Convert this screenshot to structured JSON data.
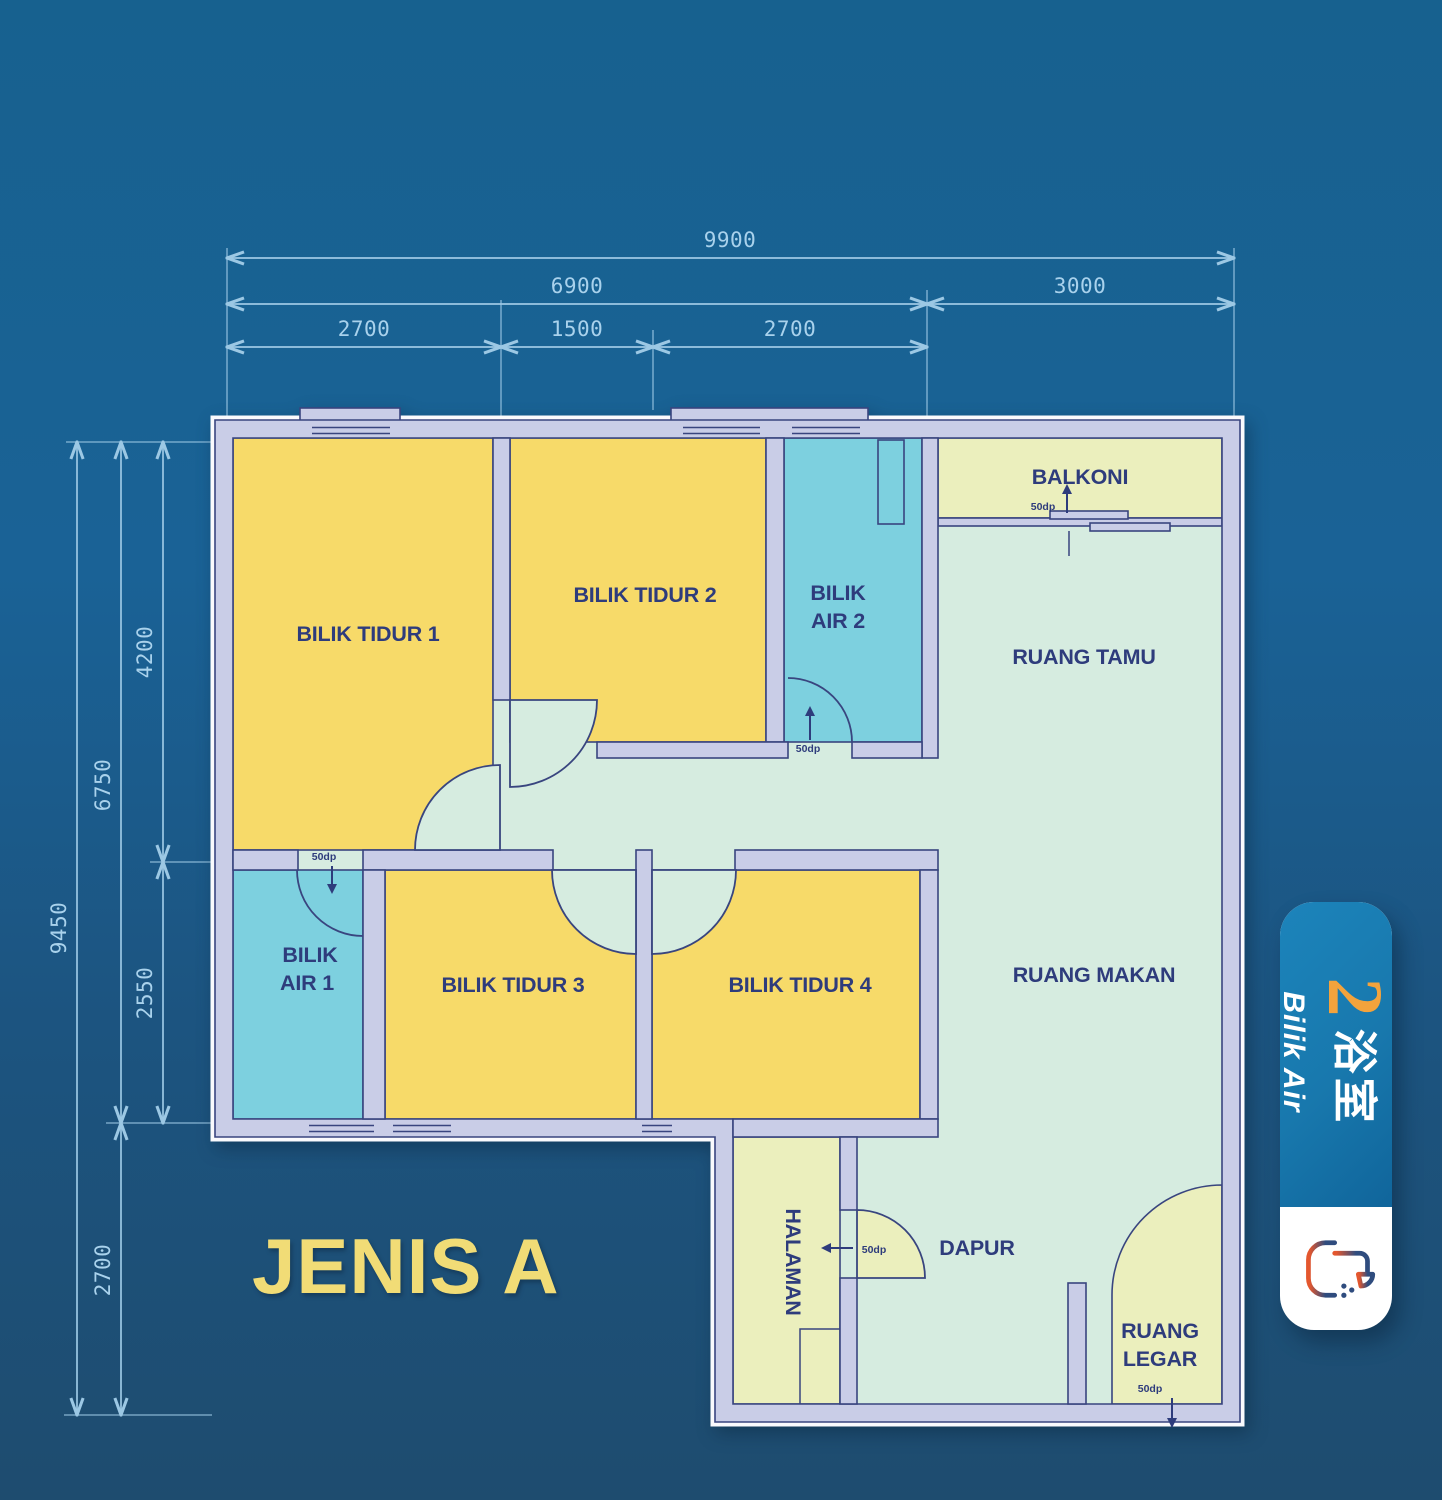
{
  "page": {
    "title": "JENIS A"
  },
  "floor_plan": {
    "rooms": {
      "bilik_tidur_1": "BILIK TIDUR 1",
      "bilik_tidur_2": "BILIK TIDUR 2",
      "bilik_tidur_3": "BILIK TIDUR 3",
      "bilik_tidur_4": "BILIK TIDUR 4",
      "bilik_air_1_line1": "BILIK",
      "bilik_air_1_line2": "AIR 1",
      "bilik_air_2_line1": "BILIK",
      "bilik_air_2_line2": "AIR 2",
      "ruang_tamu": "RUANG TAMU",
      "ruang_makan": "RUANG MAKAN",
      "balkoni": "BALKONI",
      "dapur": "DAPUR",
      "halaman": "HALAMAN",
      "ruang_legar_line1": "RUANG",
      "ruang_legar_line2": "LEGAR"
    },
    "dimensions_mm": {
      "top_total": "9900",
      "top_group_left": "6900",
      "top_group_right": "3000",
      "top_seg1": "2700",
      "top_seg2": "1500",
      "top_seg3": "2700",
      "left_total": "9450",
      "left_group_upper": "6750",
      "left_group_lower": "2700",
      "left_seg1": "4200",
      "left_seg2": "2550"
    },
    "door_label": "50dp"
  },
  "badge": {
    "bathroom_count": "2",
    "bathroom_chinese": "浴室",
    "bathroom_label": "Bilik Air"
  },
  "colors": {
    "background_top": "#17618F",
    "background_bottom": "#1E4C6F",
    "bedroom_yellow": "#F7DA69",
    "bathroom_cyan": "#7DD0DF",
    "living_mint": "#D6ECE0",
    "outdoor_pale": "#EBEFBD",
    "wall_lavender": "#C9CDE7",
    "wall_outline_navy": "#39457F",
    "dimension_blue": "#A9D2EC",
    "title_yellow": "#F1DC76",
    "badge_blue": "#1878AD",
    "badge_orange": "#F3A33C"
  }
}
